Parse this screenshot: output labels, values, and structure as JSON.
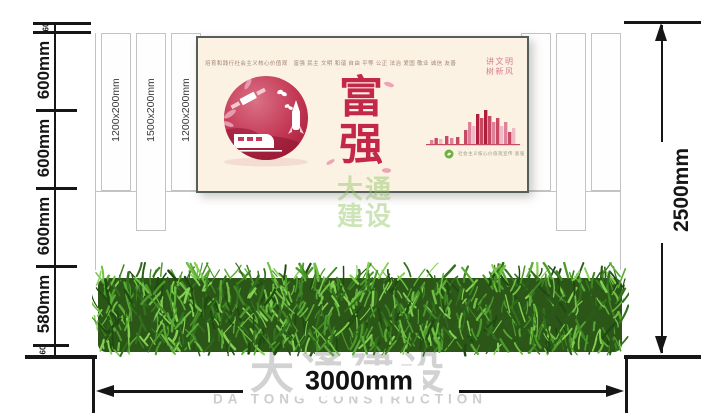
{
  "drawing": {
    "dims_left": [
      "60",
      "600mm",
      "600mm",
      "600mm",
      "580mm",
      "60"
    ],
    "dim_right": "2500mm",
    "dim_bottom": "3000mm",
    "columns": [
      {
        "label": "1200x200mm"
      },
      {
        "label": "1500x200mm"
      },
      {
        "label": "1200x200mm"
      }
    ]
  },
  "poster": {
    "values_line": "培育和践行社会主义核心价值观　富强 民主 文明 和谐 自由 平等 公正 法治 爱国 敬业 诚信 友善",
    "headline": "富强",
    "slogan_line1": "讲文明",
    "slogan_line2": "树新风",
    "footnote": "社会主义核心价值观宣传 富强"
  },
  "watermark": {
    "cn": "大通建设",
    "en": "DA TONG CONSTRUCTION",
    "center": "大通建设"
  },
  "colors": {
    "crimson": "#c3274a",
    "pink": "#dd8299",
    "poster_bg": "#fcf2e3",
    "poster_border": "#545f5c",
    "hedge_green": "#4f9430",
    "badge_green": "#6cb33e",
    "dimension_line": "#161616",
    "structure_line": "#c3c3c3",
    "watermark_gray": "#c9c9c9",
    "watermark_green": "#8dc360"
  }
}
